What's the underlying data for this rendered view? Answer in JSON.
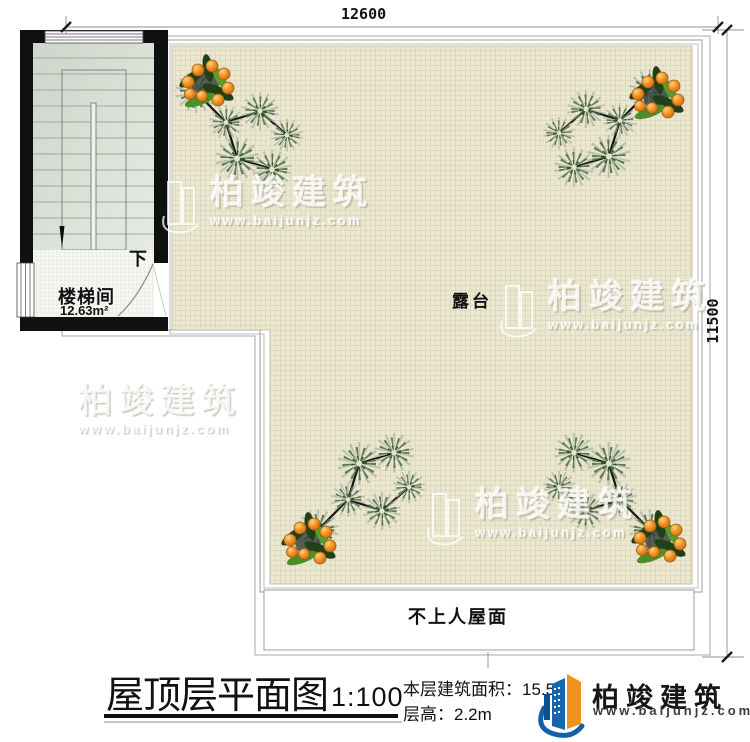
{
  "drawing": {
    "dim_top": "12600",
    "dim_right": "11500"
  },
  "plan": {
    "stairwell_name": "楼梯间",
    "stairwell_area": "12.63m²",
    "stair_direction": "下",
    "terrace_name": "露台",
    "roof_label": "不上人屋面"
  },
  "title_block": {
    "title": "屋顶层平面图",
    "scale": "1:100",
    "area_label": "本层建筑面积：",
    "area_value": "15.5",
    "height_label": "层高：",
    "height_value": "2.2m"
  },
  "brand": {
    "name": "柏竣建筑",
    "website": "www.baijunjz.com",
    "blue": "#1460a8",
    "orange": "#f0921e"
  },
  "watermark": {
    "text": "柏竣建筑",
    "url": "www.baijunjz.com"
  },
  "colors": {
    "terrace_bg": "#ebe7d1",
    "terrace_grid": "#d5cfad",
    "wall": "#101010"
  }
}
